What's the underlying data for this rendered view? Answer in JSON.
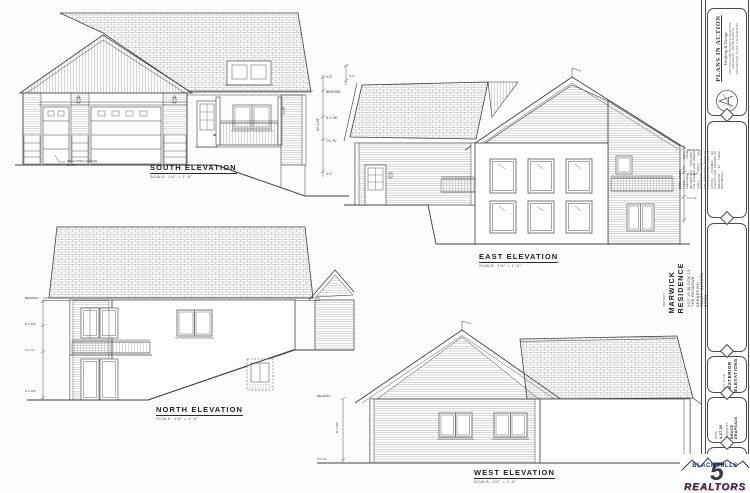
{
  "sheet": {
    "background": "#fcfcfb",
    "ink": "#3f3f3f",
    "texture": "#949494"
  },
  "elevations": {
    "south": {
      "label": "SOUTH ELEVATION",
      "scale": "SCALE: 1/4\" = 1'-0\"",
      "note_line1": "INSULATED GARAGE",
      "note_line2": "DOOR"
    },
    "east": {
      "label": "EAST ELEVATION",
      "scale": "SCALE: 1/4\" = 1'-0\""
    },
    "north": {
      "label": "NORTH ELEVATION",
      "scale": "SCALE: 1/4\" = 1'-0\""
    },
    "west": {
      "label": "WEST ELEVATION",
      "scale": "SCALE: 1/4\" = 1'-0\""
    }
  },
  "dims": {
    "south": {
      "d1": "4'-0\"",
      "d2": "BEARING",
      "d3": "8'-1 1/8\"",
      "d4": "T.O. FL.",
      "d5": "10'-1 1/8\"",
      "d6": "4'-0\""
    },
    "east": {
      "d1": "4'-0\"",
      "d2": "BEARING",
      "d3": "8'-1 1/8\"",
      "d4": "T.O. FL."
    },
    "north": {
      "d1": "BEARING",
      "d2": "8'-1 1/8\"",
      "d3": "T.O. FL.",
      "d4": "9'-1 1/8\""
    },
    "west": {
      "d1": "BEARING",
      "d2": "8'-1 1/8\"",
      "d3": "T.O. FL."
    }
  },
  "title_block": {
    "firm": {
      "name": "PLANS IN ACTION",
      "tagline": "Drafting & Design",
      "contact1": "CUSTOM HOME DESIGN & DRAFTING",
      "contact2": "SPEARFISH, SOUTH DAKOTA",
      "contact3": "RESIDENTIAL PLANS & ELEVATIONS"
    },
    "disclaimer": {
      "heading": "DISCLAIMER:",
      "body": "THESE PLANS WERE PREPARED FROM INFORMATION PROVIDED. THE BUILDER AND OWNER SHALL VERIFY ALL DIMENSIONS, DETAILS AND SITE CONDITIONS PRIOR TO CONSTRUCTION. PLANS IN ACTION ASSUMES NO LIABILITY FOR ERRORS OR OMISSIONS IN THESE DOCUMENTS."
    },
    "project": {
      "label": "PROJECT:",
      "name": "MARWICK RESIDENCE",
      "address1": "LOT 16 BLOCK 13 THE RESERVE",
      "address2": "SPEARFISH, SOUTH DAKOTA 57783"
    },
    "sheet_title": {
      "label": "SHEET TITLE:",
      "line1": "EXTERIOR",
      "line2": "ELEVATIONS"
    },
    "date": {
      "label": "DATE:",
      "value": "4-27-20"
    },
    "drawn_by": {
      "label": "DRAWN BY:",
      "value": "BRUCE DRAPEAUX"
    },
    "sheet_no": {
      "label": "SHEET:",
      "value": "5"
    },
    "realtor_logo": {
      "line1": "BLACK HILLS",
      "line2": "REALTORS",
      "number": "5",
      "navy": "#25366b",
      "red": "#c53030"
    }
  }
}
